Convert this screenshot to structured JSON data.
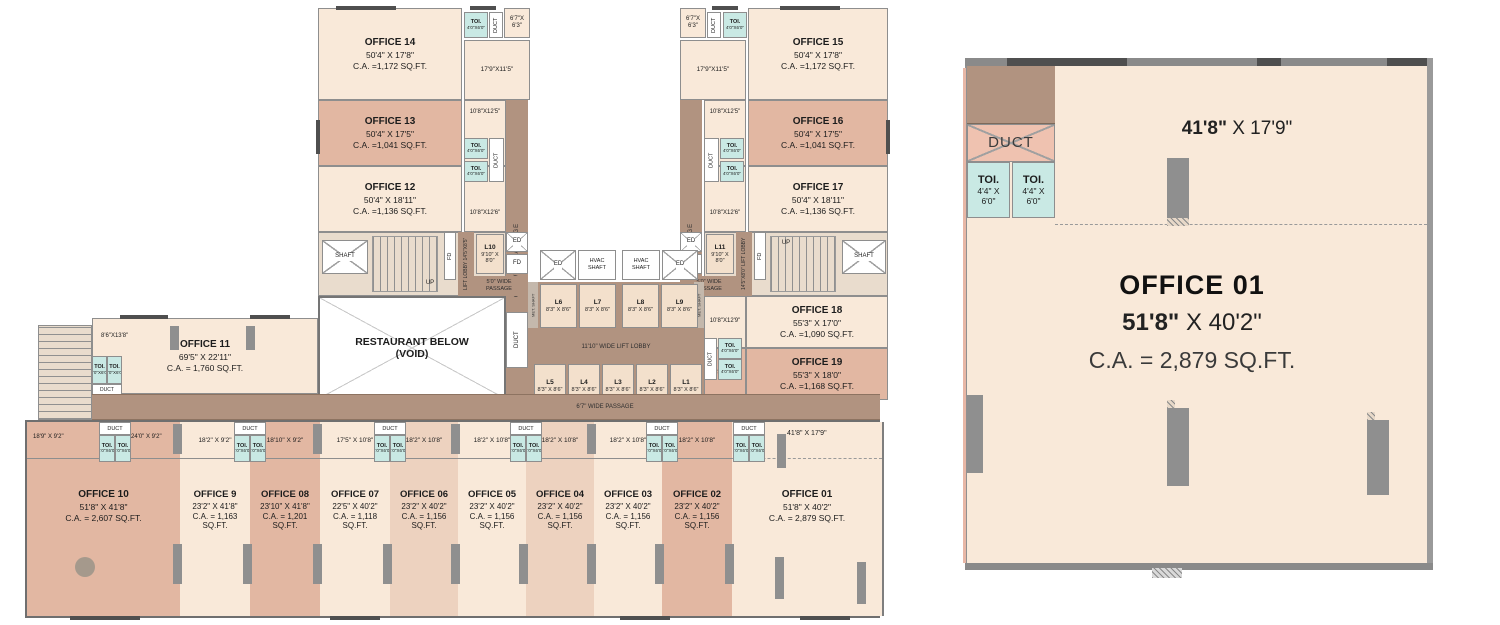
{
  "offices": {
    "o14": {
      "name": "OFFICE 14",
      "dims": "50'4\" X 17'8\"",
      "area": "C.A. =1,172 SQ.FT."
    },
    "o13": {
      "name": "OFFICE 13",
      "dims": "50'4\" X 17'5\"",
      "area": "C.A. =1,041 SQ.FT."
    },
    "o12": {
      "name": "OFFICE 12",
      "dims": "50'4\" X 18'11\"",
      "area": "C.A. =1,136 SQ.FT."
    },
    "o15": {
      "name": "OFFICE 15",
      "dims": "50'4\" X 17'8\"",
      "area": "C.A. =1,172 SQ.FT."
    },
    "o16": {
      "name": "OFFICE 16",
      "dims": "50'4\" X 17'5\"",
      "area": "C.A. =1,041 SQ.FT."
    },
    "o17": {
      "name": "OFFICE 17",
      "dims": "50'4\" X 18'11\"",
      "area": "C.A. =1,136 SQ.FT."
    },
    "o18": {
      "name": "OFFICE 18",
      "dims": "55'3\" X 17'0\"",
      "area": "C.A. =1,090 SQ.FT."
    },
    "o19": {
      "name": "OFFICE 19",
      "dims": "55'3\" X 18'0\"",
      "area": "C.A. =1,168 SQ.FT."
    },
    "o11": {
      "name": "OFFICE 11",
      "dims": "69'5\" X 22'11\"",
      "area": "C.A. = 1,760 SQ.FT."
    },
    "o10": {
      "name": "OFFICE 10",
      "dims": "51'8\" X 41'8\"",
      "area": "C.A. = 2,607 SQ.FT."
    },
    "o9": {
      "name": "OFFICE 9",
      "dims": "23'2\" X 41'8\"",
      "area": "C.A. = 1,163 SQ.FT."
    },
    "o8": {
      "name": "OFFICE 08",
      "dims": "23'10\" X 41'8\"",
      "area": "C.A. = 1,201 SQ.FT."
    },
    "o7": {
      "name": "OFFICE 07",
      "dims": "22'5\" X 40'2\"",
      "area": "C.A. = 1,118 SQ.FT."
    },
    "o6": {
      "name": "OFFICE 06",
      "dims": "23'2\" X 40'2\"",
      "area": "C.A. = 1,156 SQ.FT."
    },
    "o5": {
      "name": "OFFICE 05",
      "dims": "23'2\" X 40'2\"",
      "area": "C.A. = 1,156 SQ.FT."
    },
    "o4": {
      "name": "OFFICE 04",
      "dims": "23'2\" X 40'2\"",
      "area": "C.A. = 1,156 SQ.FT."
    },
    "o3": {
      "name": "OFFICE 03",
      "dims": "23'2\" X 40'2\"",
      "area": "C.A. = 1,156 SQ.FT."
    },
    "o2": {
      "name": "OFFICE 02",
      "dims": "23'2\" X 40'2\"",
      "area": "C.A. = 1,156 SQ.FT."
    },
    "o1": {
      "name": "OFFICE 01",
      "dims": "51'8\" X 40'2\"",
      "area": "C.A. = 2,879 SQ.FT."
    }
  },
  "labels": {
    "duct": "DUCT",
    "toi": "TOI.",
    "toi_size": "4'0\"X6'0\"",
    "ed": "ED",
    "fd": "FD",
    "up": "UP",
    "shaft": "SHAFT",
    "hvac1": "HVAC",
    "hvac2": "SHAFT",
    "met_shaft": "MET. SHAFT",
    "corner": "6'7\"X 6'3\"",
    "room_179x115": "17'9\"X11'5\"",
    "room_108x125": "10'8\"X12'5\"",
    "room_108x126": "10'8\"X12'6\"",
    "room_108x129": "10'8\"X12'9\"",
    "room_108x138": "10'8\"X13'8\"",
    "stair_86x138": "8'6\"X13'8\"",
    "passage_v": "6'7\" WIDE PASSAGE",
    "passage_h": "6'7\" WIDE PASSAGE",
    "passage_50a": "5'0\" WIDE",
    "passage_50b": "PASSAGE",
    "lift_lobby_l": "LIFT LOBBY 14'5\"X8'5\"",
    "lift_lobby_r": "14'5\"X8'0\" LIFT LOBBY",
    "lobby_main": "11'10\" WIDE LIFT LOBBY",
    "restaurant1": "RESTAURANT BELOW",
    "restaurant2": "(VOID)"
  },
  "lifts": {
    "l10_name": "L10",
    "l10_size": "9'10\" X 8'0\"",
    "l11_name": "L11",
    "l11_size": "9'10\" X 8'0\"",
    "upper": [
      {
        "n": "L6",
        "s": "8'3\" X 8'6\""
      },
      {
        "n": "L7",
        "s": "8'3\" X 8'6\""
      },
      {
        "n": "L8",
        "s": "8'3\" X 8'6\""
      },
      {
        "n": "L9",
        "s": "8'3\" X 8'6\""
      }
    ],
    "lower": [
      {
        "n": "L5",
        "s": "8'3\" X 8'6\""
      },
      {
        "n": "L4",
        "s": "8'3\" X 8'6\""
      },
      {
        "n": "L3",
        "s": "8'3\" X 8'6\""
      },
      {
        "n": "L2",
        "s": "8'3\" X 8'6\""
      },
      {
        "n": "L1",
        "s": "8'3\" X 8'6\""
      }
    ]
  },
  "strips": {
    "s10a": "18'9\" X 9'2\"",
    "s10b": "24'0\" X 9'2\"",
    "s9": "18'2\" X 9'2\"",
    "s8": "18'10\" X 9'2\"",
    "s7": "17'5\" X 10'8\"",
    "s6": "18'2\" X 10'8\"",
    "s5": "18'2\" X 10'8\"",
    "s4": "18'2\" X 10'8\"",
    "s3": "18'2\" X 10'8\"",
    "s2": "18'2\" X 10'8\"",
    "s1": "41'8\" X 17'9\""
  },
  "detail": {
    "top_dim_bold": "41'8\"",
    "top_dim_rest": " X 17'9\"",
    "name": "OFFICE 01",
    "dims_bold": "51'8\"",
    "dims_rest": " X 40'2\"",
    "area": "C.A. = 2,879 SQ.FT.",
    "duct": "DUCT",
    "toi": "TOI.",
    "toi_size1": "4'4\" X",
    "toi_size2": "6'0\""
  },
  "colors": {
    "cream": "#f9e9d9",
    "salmon": "#e2b7a2",
    "salmon_light": "#edd2bf",
    "passage_brown": "#b19380",
    "toilet_cyan": "#c9e9e4",
    "wall_gray": "#8b8b8b",
    "duct_pink": "#efc2b0"
  }
}
